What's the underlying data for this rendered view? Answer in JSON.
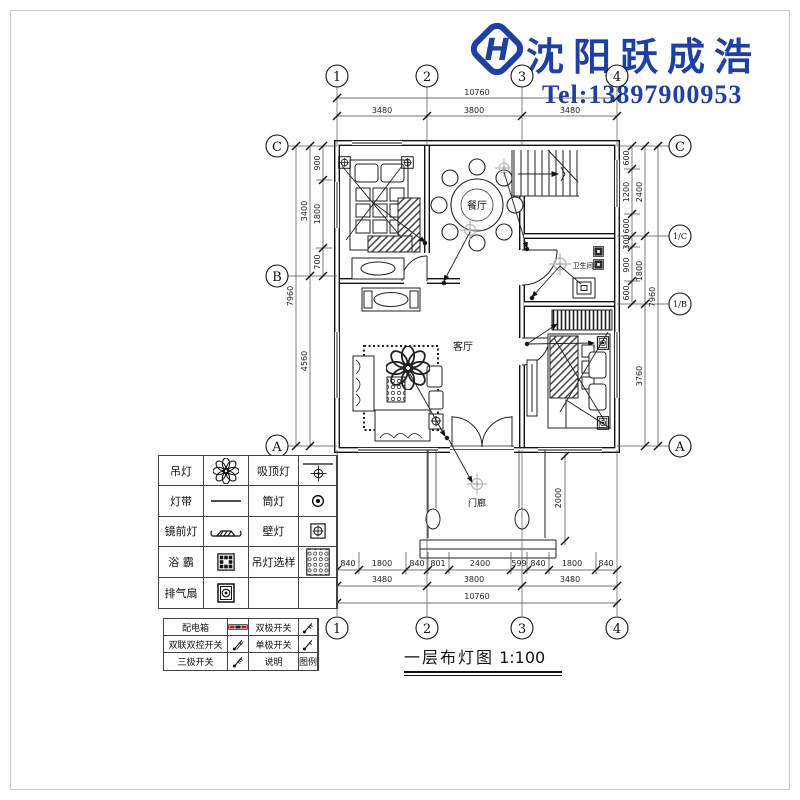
{
  "brand": {
    "name": "沈阳跃成浩",
    "tel": "Tel:13897900953",
    "accent": "#1e3fa3",
    "logo_letter": "H"
  },
  "title": {
    "text": "一层布灯图",
    "scale": "1:100"
  },
  "rooms": {
    "dining": "餐厅",
    "living": "客厅",
    "porch": "门廊",
    "bath": "卫生间"
  },
  "grid": {
    "c1": "1",
    "c2": "2",
    "c3": "3",
    "c4": "4",
    "A": "A",
    "B": "B",
    "C": "C",
    "C1": "1/C",
    "B1": "1/B"
  },
  "dims": {
    "top": {
      "overall": "10760",
      "s1": "3480",
      "s2": "3800",
      "s3": "3480"
    },
    "bottom": {
      "d1": "840",
      "d2": "1800",
      "d3": "840",
      "d4": "801",
      "d5": "2400",
      "d6": "599",
      "d7": "840",
      "d8": "1800",
      "d9": "840",
      "s1": "3480",
      "s2": "3800",
      "s3": "3480",
      "overall": "10760"
    },
    "left": {
      "overall": "7960",
      "m1": "3400",
      "m2": "4560",
      "d1": "900",
      "d2": "1800",
      "d3": "700"
    },
    "right": {
      "overall": "7960",
      "m1": "2400",
      "m2": "1800",
      "m3": "3760",
      "d1": "600",
      "d2": "1200",
      "d3": "600",
      "d4": "300",
      "d5": "900",
      "d6": "600"
    },
    "porch": "2000"
  },
  "legend_lights": {
    "rows": [
      {
        "n1": "吊灯",
        "n2": "吸顶灯"
      },
      {
        "n1": "灯带",
        "n2": "筒灯"
      },
      {
        "n1": "镜前灯",
        "n2": "壁灯"
      },
      {
        "n1": "浴 霸",
        "n2": "吊灯选样"
      },
      {
        "n1": "排气扇",
        "n2": ""
      }
    ]
  },
  "legend_electric": {
    "rows": [
      {
        "n1": "配电箱",
        "n2": "双极开关"
      },
      {
        "n1": "双联双控开关",
        "n2": "单极开关"
      },
      {
        "n1": "三极开关",
        "n2": "说明",
        "n3": "图例"
      }
    ]
  }
}
